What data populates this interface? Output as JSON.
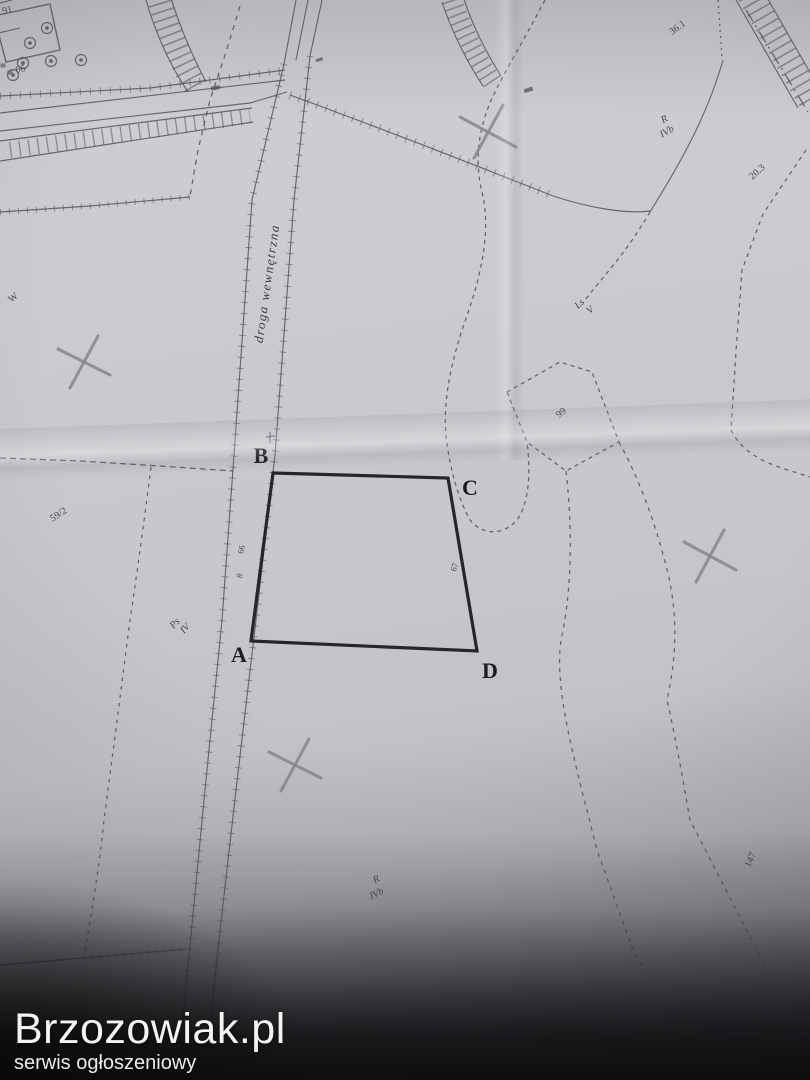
{
  "watermark": {
    "title": "Brzozowiak.pl",
    "subtitle": "serwis ogłoszeniowy"
  },
  "road": {
    "label": "droga wewnętrzna"
  },
  "parcel": {
    "corners": {
      "a": "A",
      "b": "B",
      "c": "C",
      "d": "D"
    }
  },
  "labels": {
    "building_top": "91",
    "building_number": "66",
    "w_mark": "W",
    "plot_59_2": "59/2",
    "ps_class_line1": "Ps",
    "ps_class_line2": "IV",
    "ls_class_line1": "Ls",
    "ls_class_line2": "V",
    "n99": "99",
    "r_class_top_line1": "R",
    "r_class_top_line2": "IVb",
    "n36_1": "36.1",
    "n20_3": "20.3",
    "n147": "147",
    "r_class_bottom_line1": "R",
    "r_class_bottom_line2": "IVb",
    "pt66": "66",
    "pt8": "8",
    "pt67": "67"
  },
  "colors": {
    "paper": "#c9c9cd",
    "ink": "#54545a",
    "bold_ink": "#26262a",
    "pencil_cross": "#85858b",
    "watermark_text": "#f3f3f3",
    "shadow": "#141416"
  }
}
